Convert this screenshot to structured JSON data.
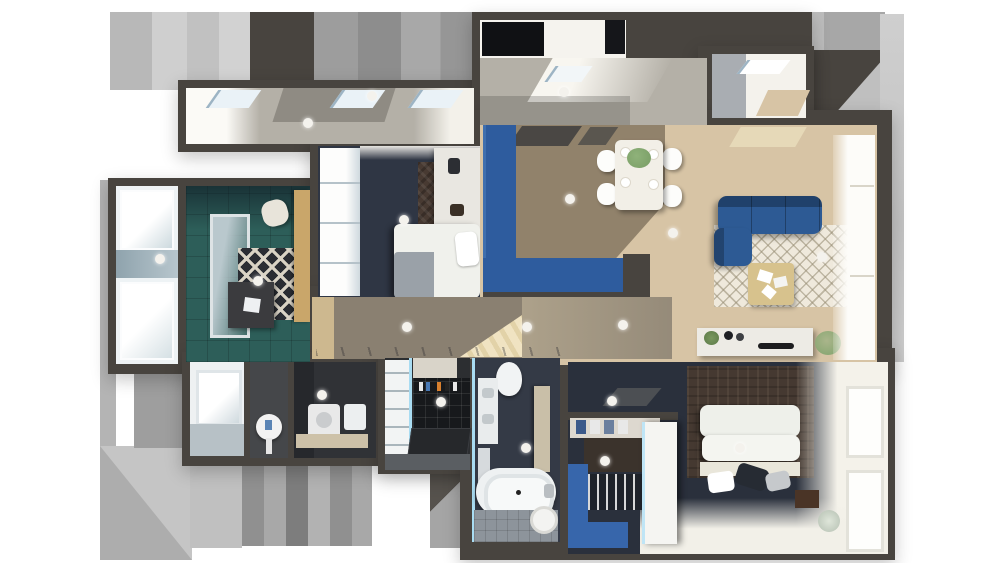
{
  "scene": {
    "type": "3d-floor-plan-render",
    "description": "Top-down 3D dollhouse render of an apartment with surrounding gray terraces",
    "background": "#ffffff",
    "lights_count": 18
  },
  "colors": {
    "bg": "#ffffff",
    "wall": "#48443f",
    "terrace-tile": "#b4b0a7",
    "tile-shadow": "#8f8b83",
    "glass-frame": "#9db4c4",
    "glass-blue": "#a9dcf2",
    "wood": "#d7c4a5",
    "wood-shadow": "#8a8071",
    "accent-blue": "#2e5c9e",
    "sofa-blue": "#2d5a94",
    "closet-blue": "#3766ab",
    "navy": "#2f3644",
    "teal": "#2d5e59",
    "rug-cream": "#efe9dc",
    "rug-dark": "#2a2d33",
    "rug-brown": "#483a32",
    "carpet-brown": "#453931",
    "bed-white": "#f0f1ec",
    "blanket-gray": "#9aa1a8",
    "tile-floor": "#8d949b",
    "black-tile": "#17191c",
    "counter-beige": "#cdc1a8",
    "wood-tan": "#c9a66a",
    "plant-green": "#7fa36b",
    "light-dot": "#f4f2ed"
  },
  "rooms": [
    {
      "id": "terrace-left",
      "label": "terrace"
    },
    {
      "id": "terrace-mid",
      "label": "terrace"
    },
    {
      "id": "balcony-top-right",
      "label": "balcony"
    },
    {
      "id": "bay-window",
      "label": "bay window"
    },
    {
      "id": "study",
      "label": "study"
    },
    {
      "id": "bedroom-2",
      "label": "bedroom"
    },
    {
      "id": "living-dining",
      "label": "living-dining room"
    },
    {
      "id": "corridor",
      "label": "hallway"
    },
    {
      "id": "storage",
      "label": "storage"
    },
    {
      "id": "wc",
      "label": "wc"
    },
    {
      "id": "laundry",
      "label": "laundry"
    },
    {
      "id": "shower-room",
      "label": "shower room"
    },
    {
      "id": "bathroom",
      "label": "bathroom"
    },
    {
      "id": "master-bedroom",
      "label": "master bedroom"
    },
    {
      "id": "walk-in-closet",
      "label": "walk-in closet"
    }
  ],
  "furniture": {
    "living_dining": [
      "blue L-shaped sectional sofa",
      "trellis-pattern rug",
      "wood coffee table with magazines",
      "dining table with four chairs and plant",
      "white sideboard with decor",
      "potted plant"
    ],
    "study": [
      "dark desk with papers",
      "geometric black-and-cream rug",
      "wood side table",
      "chair"
    ],
    "bedroom_2": [
      "double bed with gray blanket",
      "herringbone rug",
      "white wardrobe"
    ],
    "master_bedroom": [
      "double bed with pillows",
      "patterned brown carpet",
      "nightstand",
      "round vase"
    ],
    "walk_in_closet": [
      "clothes shelves",
      "white wardrobe",
      "blue floor"
    ],
    "bathroom": [
      "bathtub",
      "toilet",
      "vanity with sinks",
      "stool"
    ],
    "shower_room": [
      "black tiled shower",
      "toiletry shelf",
      "marble counter"
    ],
    "laundry": [
      "washing machine",
      "beige counter"
    ]
  }
}
